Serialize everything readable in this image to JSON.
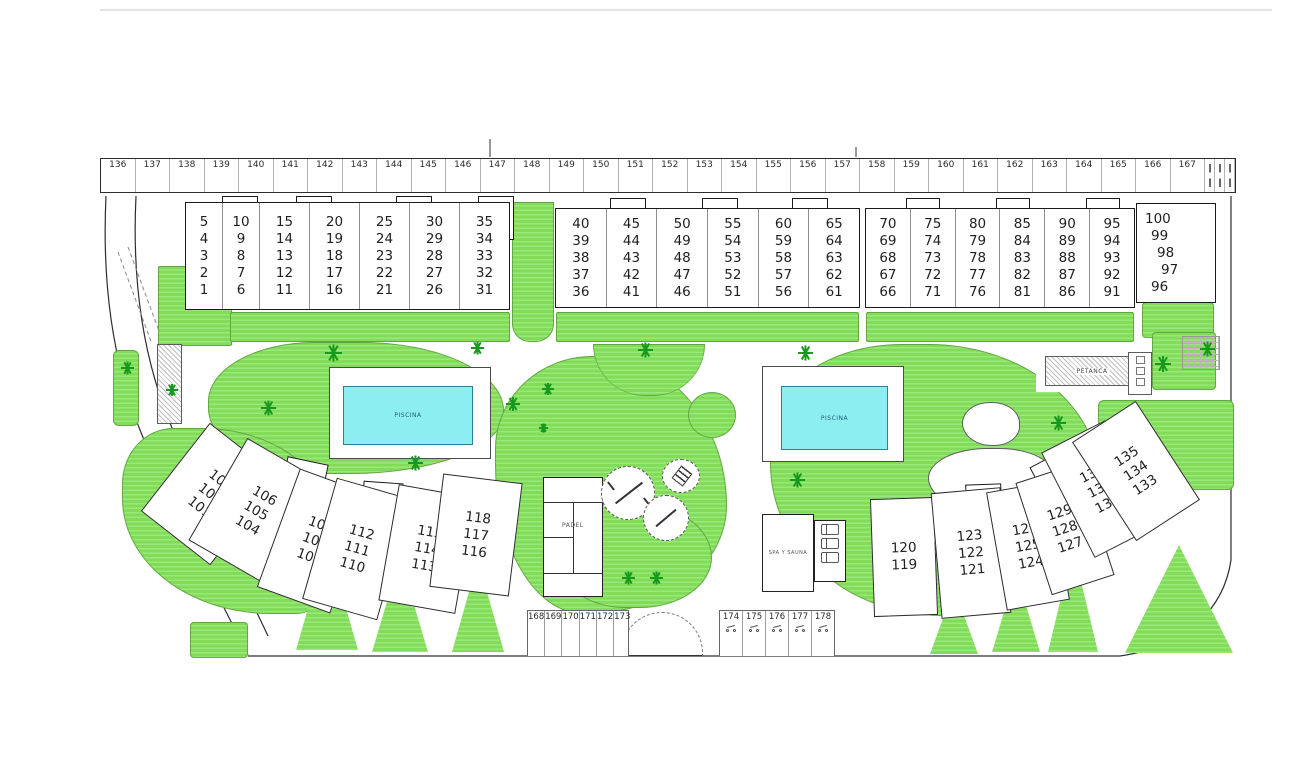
{
  "plan_title": "Residential complex site plan",
  "colors": {
    "lawn": "#82dc59",
    "lawn_stripe": "#98e87a",
    "tree": "#17991d",
    "pool_water": "#8deef2",
    "pool_border": "#2e7f98",
    "outline": "#1b1b1b"
  },
  "parking_top": {
    "numbers": [
      "136",
      "137",
      "138",
      "139",
      "140",
      "141",
      "142",
      "143",
      "144",
      "145",
      "146",
      "147",
      "148",
      "149",
      "150",
      "151",
      "152",
      "153",
      "154",
      "155",
      "156",
      "157",
      "158",
      "159",
      "160",
      "161",
      "162",
      "163",
      "164",
      "165",
      "166",
      "167"
    ]
  },
  "parking_bottom_left": {
    "numbers": [
      "168",
      "169",
      "170",
      "171",
      "172",
      "173"
    ]
  },
  "parking_bottom_right": {
    "numbers": [
      "174",
      "175",
      "176",
      "177",
      "178"
    ],
    "icon": "motorcycle-icon"
  },
  "buildings_top": [
    {
      "name": "block-1-35",
      "columns": [
        [
          "5",
          "4",
          "3",
          "2",
          "1"
        ],
        [
          "10",
          "9",
          "8",
          "7",
          "6"
        ],
        [
          "15",
          "14",
          "13",
          "12",
          "11"
        ],
        [
          "20",
          "19",
          "18",
          "17",
          "16"
        ],
        [
          "25",
          "24",
          "23",
          "22",
          "21"
        ],
        [
          "30",
          "29",
          "28",
          "27",
          "26"
        ],
        [
          "35",
          "34",
          "33",
          "32",
          "31"
        ]
      ]
    },
    {
      "name": "block-36-65",
      "columns": [
        [
          "40",
          "39",
          "38",
          "37",
          "36"
        ],
        [
          "45",
          "44",
          "43",
          "42",
          "41"
        ],
        [
          "50",
          "49",
          "48",
          "47",
          "46"
        ],
        [
          "55",
          "54",
          "53",
          "52",
          "51"
        ],
        [
          "60",
          "59",
          "58",
          "57",
          "56"
        ],
        [
          "65",
          "64",
          "63",
          "62",
          "61"
        ]
      ]
    },
    {
      "name": "block-66-95",
      "columns": [
        [
          "70",
          "69",
          "68",
          "67",
          "66"
        ],
        [
          "75",
          "74",
          "73",
          "72",
          "71"
        ],
        [
          "80",
          "79",
          "78",
          "77",
          "76"
        ],
        [
          "85",
          "84",
          "83",
          "82",
          "81"
        ],
        [
          "90",
          "89",
          "88",
          "87",
          "86"
        ],
        [
          "95",
          "94",
          "93",
          "92",
          "91"
        ]
      ]
    },
    {
      "name": "block-96-100",
      "units": [
        "100",
        "99",
        "98",
        "97",
        "96"
      ]
    }
  ],
  "buildings_lower_left": [
    {
      "units": [
        "103",
        "102",
        "101"
      ]
    },
    {
      "units": [
        "106",
        "105",
        "104"
      ]
    },
    {
      "units": [
        "109",
        "108",
        "107"
      ]
    },
    {
      "units": [
        "112",
        "111",
        "110"
      ]
    },
    {
      "units": [
        "115",
        "114",
        "113"
      ]
    },
    {
      "units": [
        "118",
        "117",
        "116"
      ]
    }
  ],
  "buildings_lower_right": [
    {
      "units": [
        "120",
        "119"
      ]
    },
    {
      "units": [
        "123",
        "122",
        "121"
      ]
    },
    {
      "units": [
        "126",
        "125",
        "124"
      ]
    },
    {
      "units": [
        "129",
        "128",
        "127"
      ]
    },
    {
      "units": [
        "132",
        "131",
        "130"
      ]
    },
    {
      "units": [
        "135",
        "134",
        "133"
      ]
    }
  ],
  "amenities": {
    "pool_left_label": "PISCINA",
    "pool_right_label": "PISCINA",
    "petanca_label": "PETANCA",
    "padel_label": "PADEL",
    "spa_label": "SPA Y SAUNA"
  }
}
